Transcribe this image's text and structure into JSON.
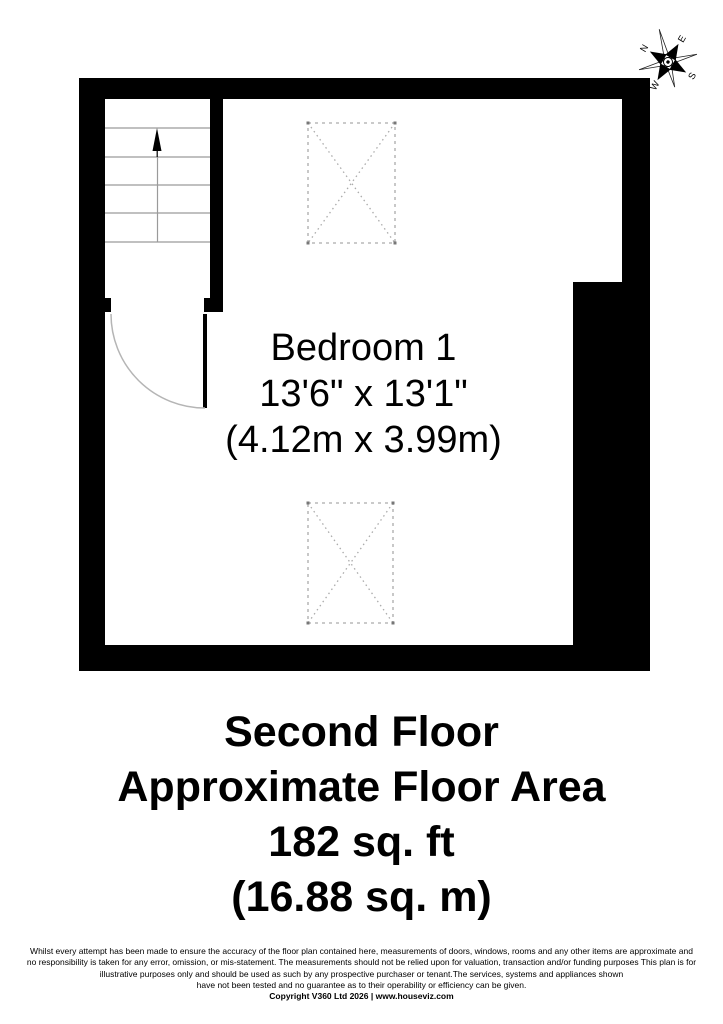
{
  "floor_plan": {
    "room": {
      "name": "Bedroom 1",
      "size_imperial": "13'6\" x 13'1\"",
      "size_metric": "(4.12m x 3.99m)"
    },
    "compass": {
      "north": "N",
      "east": "E",
      "south": "S",
      "west": "W"
    }
  },
  "title_block": {
    "floor_name": "Second Floor",
    "area_label": "Approximate Floor Area",
    "area_imperial": "182 sq. ft",
    "area_metric": "(16.88 sq. m)"
  },
  "footer": {
    "disclaimer_lines": [
      "Whilst every attempt has been made to ensure the accuracy of the floor plan contained here, measurements of doors, windows, rooms and any other items are approximate and",
      "no responsibility is taken for any error, omission, or mis-statement.  The measurements should not be relied upon for valuation, transaction and/or funding purposes This plan is for",
      "illustrative purposes only and should be used as such by any prospective purchaser or tenant.The services, systems and appliances shown",
      "have not been tested and no guarantee as to their operability or efficiency can be given."
    ],
    "copyright": "Copyright V360 Ltd 2026 | www.houseviz.com"
  },
  "colors": {
    "wall": "#000000",
    "stair_line": "#9a9a9a",
    "door_arc": "#b5b5b5",
    "dashed_symbol": "#ababab",
    "text": "#000000"
  }
}
